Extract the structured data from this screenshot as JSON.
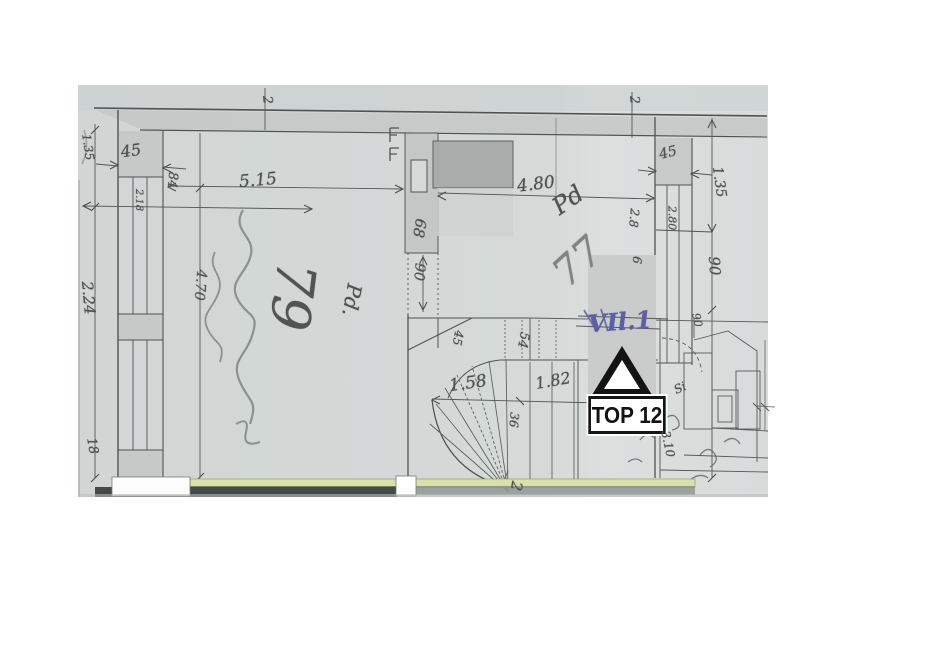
{
  "plan": {
    "kind": "scanned hand-drawn floor plan",
    "unit_marker": {
      "label": "TOP 12",
      "symbol": "triangle-up"
    },
    "colors": {
      "paper": "#d5dad9",
      "pencil": "#4e5352",
      "ink_blue": "#5b5fa3",
      "highlight": "#d9e0a9",
      "band_dark": "#454848",
      "wall_fill": "#c3c8c7",
      "flue_fill": "#a8adac",
      "patch": "#c9cccb"
    },
    "annotations": [
      {
        "name": "dim-45-top-left",
        "text": "45",
        "x": 131,
        "y": 151,
        "rot": -8,
        "size": 16
      },
      {
        "name": "dim-5-15",
        "text": "5.15",
        "x": 258,
        "y": 181,
        "rot": -5,
        "size": 17
      },
      {
        "name": "dim-4-80",
        "text": "4.80",
        "x": 536,
        "y": 185,
        "rot": -7,
        "size": 17
      },
      {
        "name": "dim-45-top-right",
        "text": "45",
        "x": 668,
        "y": 153,
        "rot": -14,
        "size": 14
      },
      {
        "name": "dim-1-35-far-left",
        "text": "1.35",
        "x": 88,
        "y": 147,
        "rot": 82,
        "size": 12
      },
      {
        "name": "dim-2-24-left",
        "text": "2.24",
        "x": 88,
        "y": 298,
        "rot": 85,
        "size": 15
      },
      {
        "name": "dim-18-left",
        "text": "18",
        "x": 92,
        "y": 446,
        "rot": 80,
        "size": 13
      },
      {
        "name": "dim-84",
        "text": "84",
        "x": 172,
        "y": 180,
        "rot": 95,
        "size": 13
      },
      {
        "name": "dim-2-18-window",
        "text": "2.18",
        "x": 138,
        "y": 200,
        "rot": 90,
        "size": 10
      },
      {
        "name": "dim-4-70",
        "text": "4.70",
        "x": 200,
        "y": 285,
        "rot": 95,
        "size": 14
      },
      {
        "name": "dim-68-pier",
        "text": "68",
        "x": 419,
        "y": 228,
        "rot": 100,
        "size": 15
      },
      {
        "name": "dim-90-center",
        "text": "90",
        "x": 419,
        "y": 272,
        "rot": 95,
        "size": 14
      },
      {
        "name": "dim-2-80-right-window",
        "text": "2.80",
        "x": 672,
        "y": 218,
        "rot": 90,
        "size": 11
      },
      {
        "name": "dim-2-8-mid",
        "text": "2.8",
        "x": 634,
        "y": 218,
        "rot": 95,
        "size": 12
      },
      {
        "name": "dim-6-mid",
        "text": "6",
        "x": 637,
        "y": 260,
        "rot": 95,
        "size": 12
      },
      {
        "name": "dim-1-35-right",
        "text": "1.35",
        "x": 719,
        "y": 182,
        "rot": 82,
        "size": 14
      },
      {
        "name": "dim-90-right",
        "text": "90",
        "x": 714,
        "y": 266,
        "rot": 86,
        "size": 15
      },
      {
        "name": "dim-1-58-stair",
        "text": "1.58",
        "x": 468,
        "y": 384,
        "rot": -8,
        "size": 17
      },
      {
        "name": "dim-1-82-stair",
        "text": "1.82",
        "x": 553,
        "y": 381,
        "rot": -10,
        "size": 16
      },
      {
        "name": "dim-54-stair",
        "text": "54",
        "x": 523,
        "y": 340,
        "rot": 100,
        "size": 13
      },
      {
        "name": "dim-45-stair",
        "text": "45",
        "x": 458,
        "y": 338,
        "rot": 100,
        "size": 12
      },
      {
        "name": "dim-36-stair",
        "text": "36",
        "x": 514,
        "y": 420,
        "rot": 95,
        "size": 12
      },
      {
        "name": "handwritten-79",
        "text": "79",
        "x": 292,
        "y": 296,
        "rot": 97,
        "size": 54,
        "style": "pencil-dark"
      },
      {
        "name": "handwritten-pd-left",
        "text": "Pd.",
        "x": 352,
        "y": 300,
        "rot": 100,
        "size": 20
      },
      {
        "name": "handwritten-pd-right",
        "text": "Pd",
        "x": 568,
        "y": 200,
        "rot": -35,
        "size": 24
      },
      {
        "name": "handwritten-77",
        "text": "77",
        "x": 578,
        "y": 262,
        "rot": -42,
        "size": 40,
        "style": "pencil-light"
      },
      {
        "name": "ink-note-vil1",
        "text": "VIl.1",
        "x": 620,
        "y": 322,
        "rot": -4,
        "size": 24,
        "style": "blue"
      },
      {
        "name": "handwritten-2-stair",
        "text": "2",
        "x": 516,
        "y": 486,
        "rot": 100,
        "size": 15
      },
      {
        "name": "handwritten-si-bath",
        "text": "Si",
        "x": 680,
        "y": 388,
        "rot": -25,
        "size": 12
      },
      {
        "name": "handwritten-3-10-bath",
        "text": "3.10",
        "x": 668,
        "y": 444,
        "rot": 78,
        "size": 12
      },
      {
        "name": "handwritten-90-bath",
        "text": "90",
        "x": 697,
        "y": 320,
        "rot": 78,
        "size": 11
      },
      {
        "name": "tick-2-top-left",
        "text": "2",
        "x": 267,
        "y": 100,
        "rot": 85,
        "size": 13
      },
      {
        "name": "tick-2-top-right",
        "text": "2",
        "x": 634,
        "y": 100,
        "rot": 85,
        "size": 13
      }
    ]
  }
}
